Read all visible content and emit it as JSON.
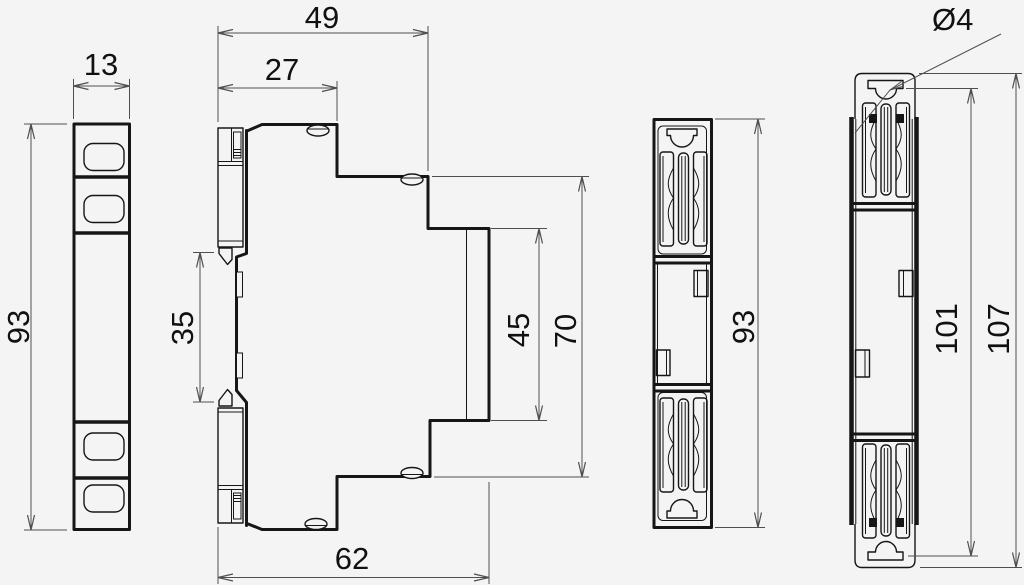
{
  "colors": {
    "background": "#f4f4f4",
    "outline": "#161616",
    "dimension": "#4f4f4f"
  },
  "dimensions": {
    "front_width": "13",
    "front_height": "93",
    "top_depth": "49",
    "terminal_depth": "27",
    "clip_gap": "35",
    "face_height": "45",
    "body_height": "70",
    "bottom_depth": "62",
    "rear_height": "93",
    "hole_diameter": "Ø4",
    "clip_inner_height": "101",
    "overall_height": "107"
  }
}
